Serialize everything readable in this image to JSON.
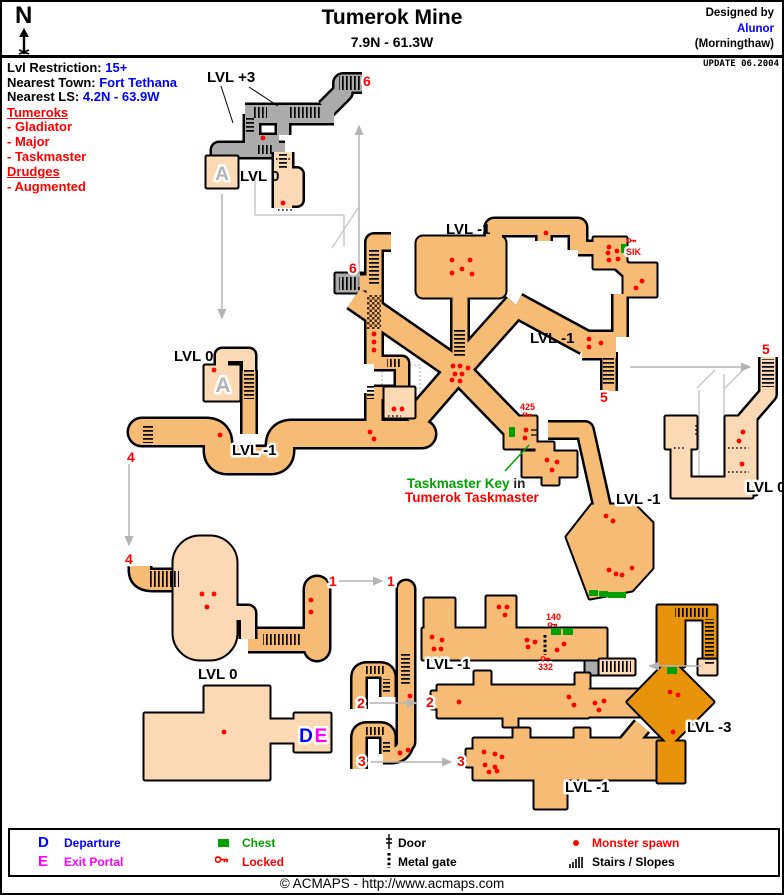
{
  "header": {
    "title": "Tumerok Mine",
    "coords": "7.9N - 61.3W",
    "designed_by": "Designed by",
    "designer": "Alunor",
    "designer_world": "(Morningthaw)",
    "compass": "N",
    "update": "UPDATE 06.2004"
  },
  "info": {
    "lvl_restriction_label": "Lvl Restriction:",
    "lvl_restriction": "15+",
    "town_label": "Nearest Town:",
    "town": "Fort Tethana",
    "ls_label": "Nearest LS:",
    "ls": "4.2N - 63.9W",
    "tumeroks_heading": "Tumeroks",
    "tumeroks": [
      "- Gladiator",
      "- Major",
      "- Taskmaster"
    ],
    "drudges_heading": "Drudges",
    "drudges": [
      "- Augmented"
    ]
  },
  "map": {
    "labels": [
      {
        "t": "LVL +3",
        "x": 205,
        "y": 80
      },
      {
        "t": "LVL 0",
        "x": 238,
        "y": 179
      },
      {
        "t": "LVL -1",
        "x": 444,
        "y": 232
      },
      {
        "t": "LVL 0",
        "x": 172,
        "y": 359
      },
      {
        "t": "LVL -1",
        "x": 528,
        "y": 341
      },
      {
        "t": "LVL -1",
        "x": 230,
        "y": 453,
        "halo": 1
      },
      {
        "t": "LVL -1",
        "x": 614,
        "y": 502,
        "halo": 1
      },
      {
        "t": "LVL 0",
        "x": 744,
        "y": 490,
        "halo": 1
      },
      {
        "t": "LVL 0",
        "x": 196,
        "y": 677
      },
      {
        "t": "LVL -1",
        "x": 424,
        "y": 667,
        "halo": 1
      },
      {
        "t": "LVL -3",
        "x": 685,
        "y": 730,
        "halo": 1
      },
      {
        "t": "LVL -1",
        "x": 563,
        "y": 790,
        "halo": 1
      }
    ],
    "portals": [
      {
        "t": "6",
        "x": 361,
        "y": 84
      },
      {
        "t": "6",
        "x": 347,
        "y": 271
      },
      {
        "t": "5",
        "x": 598,
        "y": 400
      },
      {
        "t": "5",
        "x": 760,
        "y": 352
      },
      {
        "t": "4",
        "x": 125,
        "y": 460
      },
      {
        "t": "4",
        "x": 123,
        "y": 562
      },
      {
        "t": "1",
        "x": 327,
        "y": 584
      },
      {
        "t": "1",
        "x": 385,
        "y": 584
      },
      {
        "t": "2",
        "x": 355,
        "y": 706
      },
      {
        "t": "2",
        "x": 424,
        "y": 705
      },
      {
        "t": "3",
        "x": 356,
        "y": 764
      },
      {
        "t": "3",
        "x": 455,
        "y": 764
      }
    ],
    "key_markers": [
      {
        "t": "SIK",
        "tx": 624,
        "ty": 253,
        "ix": 625,
        "iy": 236
      },
      {
        "t": "425",
        "tx": 518,
        "ty": 408,
        "ix": 521,
        "iy": 410
      },
      {
        "t": "140",
        "tx": 544,
        "ty": 618,
        "ix": 546,
        "iy": 620
      },
      {
        "t": "332",
        "tx": 536,
        "ty": 668,
        "ix": 539,
        "iy": 654
      }
    ],
    "note": {
      "line1_green": "Taskmaster Key",
      "line1_black": " in",
      "line2": "Tumerok Taskmaster"
    },
    "room_letters": [
      {
        "t": "A",
        "x": 220,
        "y": 178,
        "size": 19,
        "color": "#b5b5b5"
      },
      {
        "t": "A",
        "x": 221,
        "y": 390,
        "size": 21,
        "color": "#b5b5b5"
      },
      {
        "t": "D",
        "x": 304,
        "y": 740,
        "size": 19,
        "color": "#0000ff"
      },
      {
        "t": "E",
        "x": 319,
        "y": 740,
        "size": 19,
        "color": "#ff00ff"
      }
    ],
    "spawns": [
      [
        261,
        136
      ],
      [
        281,
        201
      ],
      [
        450,
        258
      ],
      [
        468,
        258
      ],
      [
        450,
        271
      ],
      [
        460,
        267
      ],
      [
        470,
        272
      ],
      [
        544,
        231
      ],
      [
        607,
        245
      ],
      [
        615,
        249
      ],
      [
        606,
        251
      ],
      [
        616,
        257
      ],
      [
        607,
        258
      ],
      [
        640,
        279
      ],
      [
        634,
        286
      ],
      [
        587,
        337
      ],
      [
        587,
        345
      ],
      [
        599,
        341
      ],
      [
        372,
        332
      ],
      [
        372,
        340
      ],
      [
        372,
        348
      ],
      [
        392,
        407
      ],
      [
        400,
        407
      ],
      [
        451,
        364
      ],
      [
        458,
        364
      ],
      [
        466,
        366
      ],
      [
        453,
        372
      ],
      [
        460,
        372
      ],
      [
        450,
        378
      ],
      [
        458,
        379
      ],
      [
        218,
        433
      ],
      [
        368,
        430
      ],
      [
        372,
        437
      ],
      [
        524,
        428
      ],
      [
        523,
        436
      ],
      [
        545,
        458
      ],
      [
        555,
        460
      ],
      [
        550,
        468
      ],
      [
        604,
        514
      ],
      [
        611,
        519
      ],
      [
        607,
        568
      ],
      [
        614,
        572
      ],
      [
        620,
        573
      ],
      [
        630,
        566
      ],
      [
        741,
        430
      ],
      [
        737,
        439
      ],
      [
        740,
        462
      ],
      [
        200,
        592
      ],
      [
        212,
        592
      ],
      [
        205,
        605
      ],
      [
        309,
        598
      ],
      [
        309,
        610
      ],
      [
        408,
        694
      ],
      [
        398,
        751
      ],
      [
        406,
        748
      ],
      [
        222,
        730
      ],
      [
        212,
        368
      ],
      [
        497,
        605
      ],
      [
        505,
        605
      ],
      [
        503,
        613
      ],
      [
        430,
        635
      ],
      [
        440,
        638
      ],
      [
        432,
        647
      ],
      [
        439,
        647
      ],
      [
        525,
        638
      ],
      [
        533,
        640
      ],
      [
        526,
        645
      ],
      [
        562,
        642
      ],
      [
        555,
        648
      ],
      [
        457,
        700
      ],
      [
        567,
        695
      ],
      [
        572,
        703
      ],
      [
        593,
        701
      ],
      [
        602,
        699
      ],
      [
        597,
        708
      ],
      [
        482,
        750
      ],
      [
        493,
        752
      ],
      [
        500,
        755
      ],
      [
        483,
        763
      ],
      [
        493,
        765
      ],
      [
        487,
        770
      ],
      [
        495,
        769
      ],
      [
        668,
        690
      ],
      [
        676,
        693
      ],
      [
        671,
        730
      ]
    ],
    "chests": [
      [
        619,
        242,
        6,
        9
      ],
      [
        507,
        425,
        6,
        10
      ],
      [
        549,
        626,
        10,
        7
      ],
      [
        561,
        626,
        10,
        7
      ],
      [
        587,
        588,
        9,
        6
      ],
      [
        597,
        589,
        9,
        6
      ],
      [
        606,
        590,
        9,
        6
      ],
      [
        615,
        590,
        9,
        6
      ],
      [
        665,
        665,
        10,
        7
      ]
    ]
  },
  "legend": {
    "departure_letter": "D",
    "departure": "Departure",
    "exit_letter": "E",
    "exit": "Exit Portal",
    "chest": "Chest",
    "locked": "Locked",
    "door": "Door",
    "metal_gate": "Metal gate",
    "monster_spawn": "Monster spawn",
    "stairs": "Stairs / Slopes"
  },
  "footer": {
    "copyright": "© ACMAPS - http://www.acmaps.com"
  },
  "colors": {
    "level_plus3": "#ababab",
    "level_0": "#fcd9b5",
    "level_minus1": "#f6bc75",
    "level_minus3": "#e8930c",
    "accent_blue": "#0000ff",
    "accent_red": "#ff0000",
    "accent_magenta": "#ff00ff",
    "accent_green": "#00a000"
  }
}
